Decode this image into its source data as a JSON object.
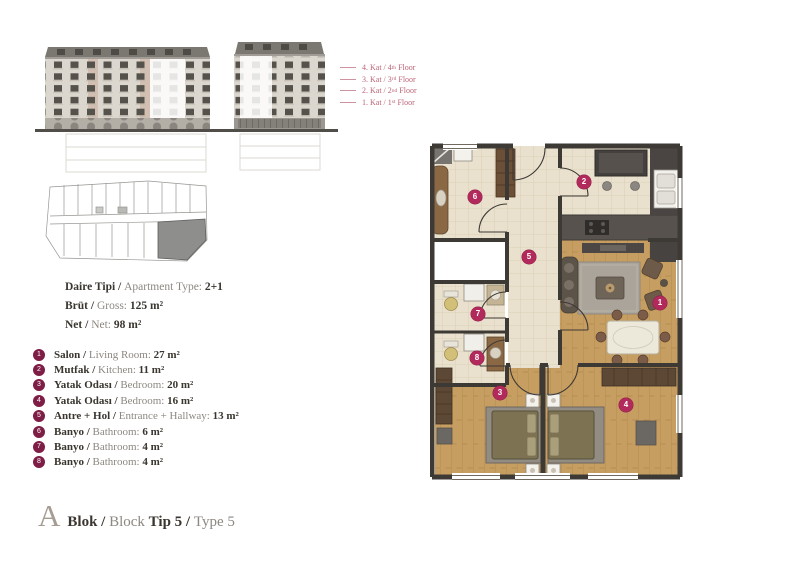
{
  "floors_legend": [
    {
      "tr": "4. Kat / ",
      "num": "4",
      "sup": "th",
      "word": " Floor"
    },
    {
      "tr": "3. Kat / ",
      "num": "3",
      "sup": "rd",
      "word": " Floor"
    },
    {
      "tr": "2. Kat / ",
      "num": "2",
      "sup": "nd",
      "word": " Floor"
    },
    {
      "tr": "1. Kat / ",
      "num": "1",
      "sup": "st",
      "word": " Floor"
    }
  ],
  "apartment_info": {
    "rows": [
      {
        "tr": "Daire Tipi / ",
        "en": "Apartment Type: ",
        "value": "2+1"
      },
      {
        "tr": "Brüt / ",
        "en": "Gross: ",
        "value": "125 m²"
      },
      {
        "tr": "Net / ",
        "en": "Net: ",
        "value": "98 m²"
      }
    ]
  },
  "rooms": [
    {
      "num": "1",
      "tr": "Salon / ",
      "en": "Living Room: ",
      "value": "27 m²"
    },
    {
      "num": "2",
      "tr": "Mutfak / ",
      "en": "Kitchen: ",
      "value": "11 m²"
    },
    {
      "num": "3",
      "tr": "Yatak Odası / ",
      "en": "Bedroom: ",
      "value": "20 m²"
    },
    {
      "num": "4",
      "tr": "Yatak Odası / ",
      "en": "Bedroom: ",
      "value": "16 m²"
    },
    {
      "num": "5",
      "tr": "Antre + Hol / ",
      "en": "Entrance + Hallway: ",
      "value": "13 m²"
    },
    {
      "num": "6",
      "tr": "Banyo / ",
      "en": "Bathroom: ",
      "value": "6 m²"
    },
    {
      "num": "7",
      "tr": "Banyo / ",
      "en": "Bathroom: ",
      "value": "4 m²"
    },
    {
      "num": "8",
      "tr": "Banyo / ",
      "en": "Bathroom: ",
      "value": "4 m²"
    }
  ],
  "footer": {
    "letter": "A",
    "block_tr": "Blok / ",
    "block_en": "Block ",
    "type_tr": "Tip 5 / ",
    "type_en": "Type 5"
  },
  "colors": {
    "accent_pink": "#bc6577",
    "list_badge": "#7e1d46",
    "plan_marker": "#b12a5b",
    "text_dark": "#3a352e",
    "text_gray": "#8d8780"
  }
}
